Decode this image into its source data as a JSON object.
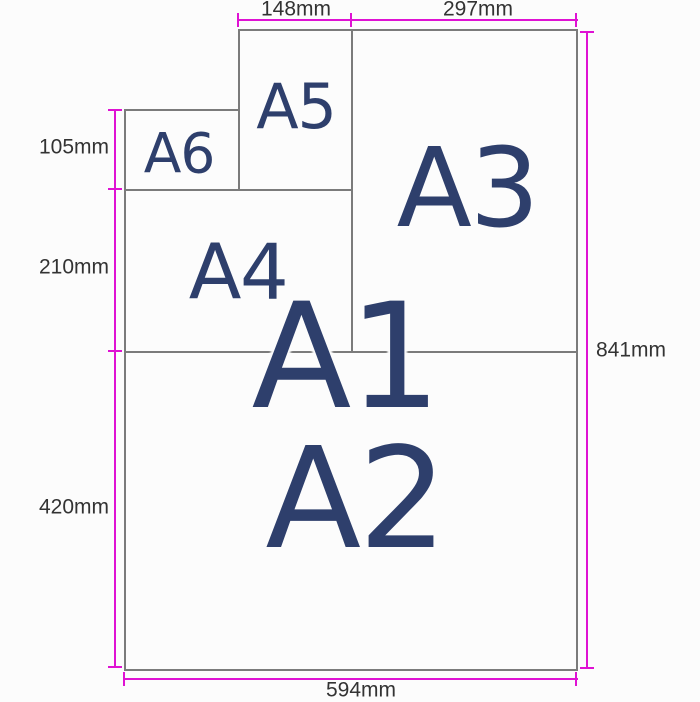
{
  "diagram": {
    "papers": [
      {
        "name": "A1"
      },
      {
        "name": "A2"
      },
      {
        "name": "A3"
      },
      {
        "name": "A4"
      },
      {
        "name": "A5"
      },
      {
        "name": "A6"
      }
    ],
    "dimensions": {
      "top": [
        {
          "label": "148mm"
        },
        {
          "label": "297mm"
        }
      ],
      "left": [
        {
          "label": "105mm"
        },
        {
          "label": "210mm"
        },
        {
          "label": "420mm"
        }
      ],
      "right": [
        {
          "label": "841mm"
        }
      ],
      "bottom": [
        {
          "label": "594mm"
        }
      ]
    },
    "colors": {
      "dimension_line": "#df12d3",
      "paper_border": "#7b7b7b",
      "paper_label": "#2e3f6c",
      "dimension_text": "#333333",
      "background": "#fcfcfc"
    }
  }
}
